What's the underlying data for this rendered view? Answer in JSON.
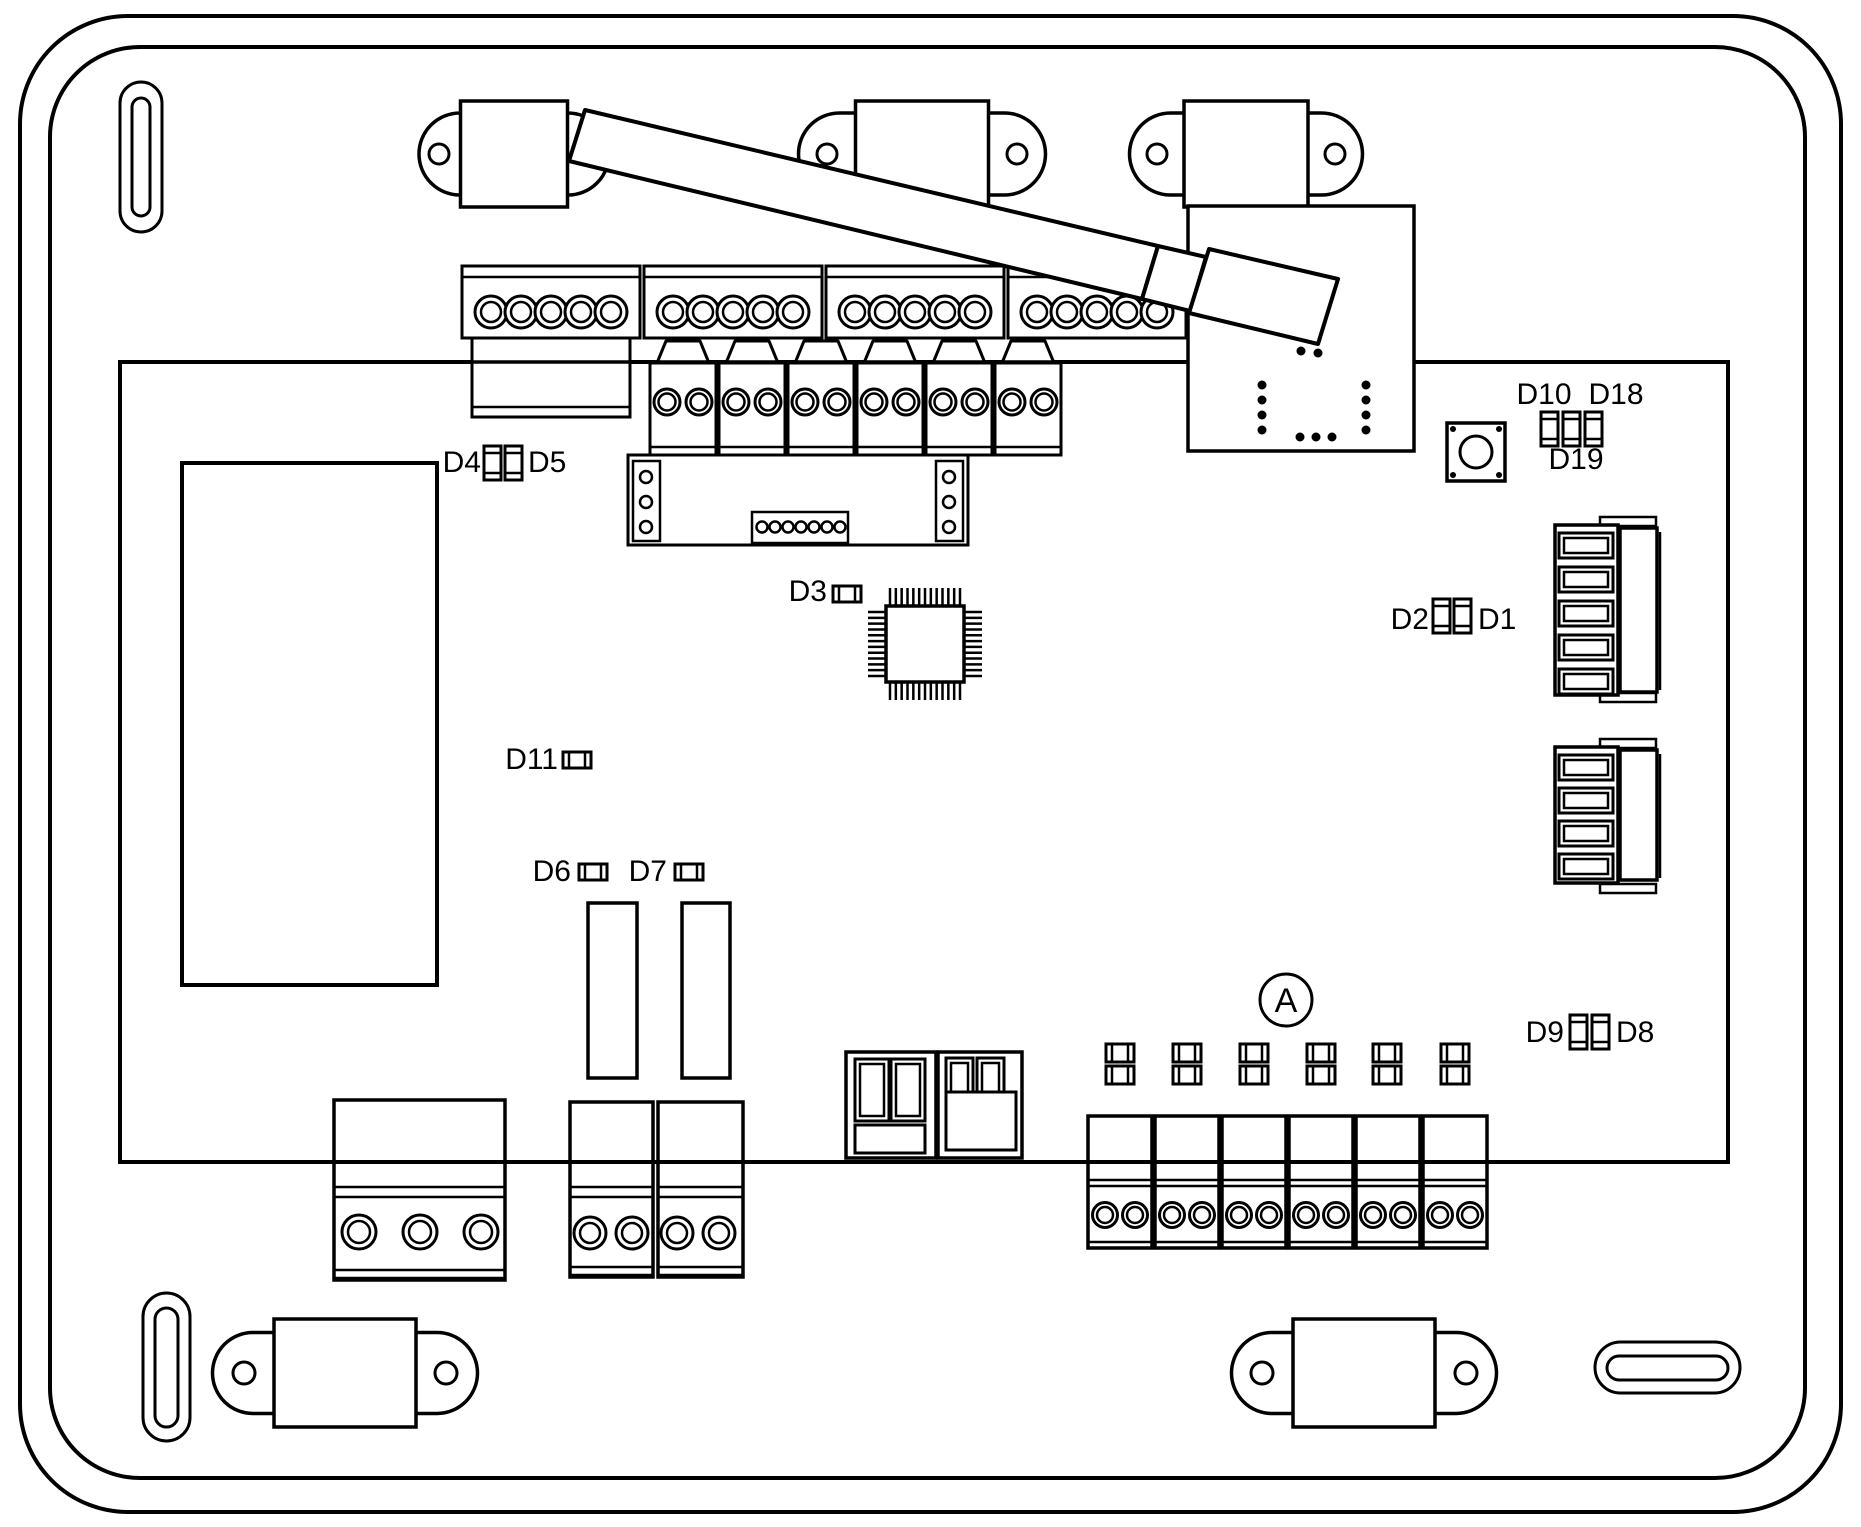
{
  "diagram": {
    "type": "control-board line drawing",
    "colors": {
      "line": "#000000",
      "background": "#ffffff"
    },
    "labels": {
      "d1": "D1",
      "d2": "D2",
      "d3": "D3",
      "d4": "D4",
      "d5": "D5",
      "d6": "D6",
      "d7": "D7",
      "d8": "D8",
      "d9": "D9",
      "d10": "D10",
      "d11": "D11",
      "d18": "D18",
      "d19": "D19",
      "point_a": "A"
    }
  },
  "board": {
    "enclosure": {
      "outer": [
        20,
        16,
        1821,
        1496,
        108
      ],
      "inner": [
        50,
        47,
        1755,
        1431,
        90
      ]
    },
    "pcb": [
      120,
      362,
      1608,
      800
    ],
    "transformer": [
      182,
      463,
      255,
      522
    ],
    "slots": [
      {
        "outer": [
          120,
          82,
          42,
          150
        ],
        "inner": [
          132,
          98,
          18,
          118
        ]
      },
      {
        "outer": [
          143,
          1293,
          47,
          148
        ],
        "inner": [
          155,
          1308,
          23,
          119
        ]
      },
      {
        "outer": [
          1595,
          1342,
          145,
          51
        ],
        "inner": [
          1607,
          1356,
          121,
          24
        ]
      }
    ],
    "tabs": [
      {
        "cx": 514,
        "cy": 154,
        "pw": 190,
        "ph": 82,
        "rw": 107,
        "rh": 106,
        "dx": 75,
        "hr": 10
      },
      {
        "cx": 922,
        "cy": 154,
        "pw": 247,
        "ph": 82,
        "rw": 133,
        "rh": 106,
        "dx": 95,
        "hr": 10
      },
      {
        "cx": 1246,
        "cy": 154,
        "pw": 233,
        "ph": 82,
        "rw": 124,
        "rh": 106,
        "dx": 89,
        "hr": 10
      },
      {
        "cx": 345,
        "cy": 1373,
        "pw": 265,
        "ph": 81,
        "rw": 142,
        "rh": 108,
        "dx": 101,
        "hr": 11
      },
      {
        "cx": 1364,
        "cy": 1373,
        "pw": 265,
        "ph": 81,
        "rw": 142,
        "rh": 108,
        "dx": 102,
        "hr": 11
      }
    ],
    "top_strip": {
      "blocks_x": [
        462,
        644,
        826,
        1008
      ],
      "w": 178,
      "y": 266,
      "h": 72,
      "inner_line_y": 277,
      "screws": 5,
      "screw_cy": 312,
      "r_out": 16,
      "r_in": 10,
      "extension": [
        472,
        338,
        158,
        79
      ],
      "extension_line_y": 407
    },
    "second_row": {
      "blocks_x": [
        650,
        719,
        788,
        857,
        926,
        995
      ],
      "w": 66,
      "y": 363,
      "h": 92,
      "line_y": 447,
      "screw_cy": 402,
      "screw_dx": [
        17,
        49
      ],
      "r_out": 13,
      "r_in": 8.5,
      "trap_top_y": 341
    },
    "header_strip": {
      "body": [
        628,
        455,
        340,
        90
      ],
      "mini_left": {
        "rect": [
          633,
          461,
          27,
          80
        ],
        "cx": 646,
        "cys": [
          477,
          502,
          527
        ],
        "r": 6
      },
      "mini_right": {
        "rect": [
          936,
          461,
          27,
          80
        ],
        "cx": 949,
        "cys": [
          477,
          502,
          527
        ],
        "r": 6
      },
      "center": {
        "rect": [
          752,
          512,
          96,
          31
        ],
        "cy": 527,
        "cx0": 762,
        "step": 13,
        "n": 7,
        "r": 5.5
      }
    },
    "rf_module": {
      "rect": [
        1188,
        206,
        226,
        245
      ],
      "cluster": [
        [
          1300,
          335
        ],
        [
          1317,
          339
        ],
        [
          1301,
          351
        ],
        [
          1318,
          353
        ]
      ],
      "col_left_x": 1262,
      "col_right_x": 1366,
      "col_ys": [
        385,
        400,
        415,
        430
      ],
      "row_y": 437,
      "row_xs": [
        1300,
        1316,
        1332
      ],
      "dot_r": 4.5
    },
    "antenna": {
      "segments": [
        "585,110 1158,246 1142,299 569,161",
        "1158,246 1206,257 1190,311 1142,299",
        "1209,249 1338,279 1318,344 1189,313"
      ]
    },
    "mcu": {
      "body": [
        886,
        606,
        78,
        76
      ],
      "frame": [
        868,
        588,
        114,
        112
      ],
      "pins_top": 13,
      "pins_side": 12
    },
    "relays": [
      [
        588,
        903,
        49,
        175
      ],
      [
        682,
        903,
        48,
        175
      ]
    ],
    "push_button": {
      "rect": [
        1447,
        423,
        58,
        58
      ],
      "circle": [
        1476,
        452,
        16
      ],
      "dot_r": 3,
      "dot_inset": 6
    },
    "right_connectors": [
      {
        "body": [
          1555,
          525,
          63,
          170
        ],
        "slot_x": 1559,
        "slot_w": 54,
        "slot_h": 25,
        "slot_tops": [
          533,
          567,
          601,
          635,
          669
        ],
        "plate": [
          1620,
          528,
          37,
          164
        ],
        "vline": [
          1660,
          532,
          690
        ],
        "steps": [
          [
            1600,
            517,
            56,
            9
          ],
          [
            1600,
            693,
            56,
            9
          ]
        ]
      },
      {
        "body": [
          1555,
          747,
          63,
          136
        ],
        "slot_x": 1559,
        "slot_w": 54,
        "slot_h": 25,
        "slot_tops": [
          755,
          788,
          821,
          854
        ],
        "plate": [
          1620,
          750,
          37,
          130
        ],
        "vline": [
          1660,
          754,
          878
        ],
        "steps": [
          [
            1600,
            739,
            56,
            9
          ],
          [
            1600,
            884,
            56,
            9
          ]
        ]
      }
    ],
    "bottom_left": [
      {
        "rect": [
          334,
          1100,
          171,
          180
        ],
        "lines": [
          1187,
          1197,
          1270,
          1278
        ],
        "screw_cx": [
          359,
          420,
          481
        ],
        "screw_cy": 1232,
        "r_out": 17,
        "r_in": 11
      },
      {
        "rect": [
          570,
          1102,
          83,
          175
        ],
        "lines": [
          1187,
          1197,
          1267,
          1275
        ],
        "screw_cx": [
          590,
          632
        ],
        "screw_cy": 1233,
        "r_out": 16,
        "r_in": 10
      },
      {
        "rect": [
          658,
          1102,
          85,
          175
        ],
        "lines": [
          1187,
          1197,
          1267,
          1275
        ],
        "screw_cx": [
          677,
          719
        ],
        "screw_cy": 1233,
        "r_out": 16,
        "r_in": 10
      }
    ],
    "middle_connectors": {
      "c1": {
        "body": [
          846,
          1052,
          90,
          106
        ],
        "slots": [
          [
            855,
            1059,
            34,
            62
          ],
          [
            891,
            1059,
            34,
            62
          ]
        ],
        "inset": 5,
        "bottom": [
          855,
          1125,
          70,
          28
        ]
      },
      "c2": {
        "body": [
          938,
          1052,
          84,
          106
        ],
        "slots": [
          [
            946,
            1058,
            27,
            42
          ],
          [
            977,
            1058,
            27,
            42
          ]
        ],
        "inset": 5,
        "bottom": [
          946,
          1092,
          70,
          58
        ]
      }
    },
    "led_pairs": {
      "cx": [
        1120,
        1187,
        1254,
        1321,
        1387,
        1455
      ],
      "y_top": 1044,
      "y_bot": 1066,
      "w": 28,
      "h": 18
    },
    "bottom_right": {
      "blocks_x": [
        1088,
        1155,
        1222,
        1289,
        1356,
        1423
      ],
      "w": 64,
      "y": 1116,
      "h": 132,
      "lines": [
        1180,
        1186,
        1242
      ],
      "screw_dx": [
        17,
        47
      ],
      "screw_cy": 1215,
      "r_out": 12.5,
      "r_in": 8
    },
    "point_a": {
      "cx": 1286,
      "cy": 1000,
      "r": 26
    },
    "led_packages": {
      "vertical": [
        [
          484,
          446
        ],
        [
          505,
          446
        ],
        [
          1433,
          599
        ],
        [
          1454,
          599
        ],
        [
          1541,
          412
        ],
        [
          1563,
          412
        ],
        [
          1585,
          412
        ],
        [
          1570,
          1015
        ],
        [
          1592,
          1015
        ]
      ],
      "v_size": [
        17,
        34
      ],
      "horizontal": [
        [
          563,
          752
        ],
        [
          579,
          864
        ],
        [
          675,
          864
        ],
        [
          833,
          586
        ]
      ],
      "h_size": [
        28,
        16
      ]
    },
    "label_pos": [
      {
        "key": "d4",
        "x": 481,
        "y": 472,
        "anchor": "end"
      },
      {
        "key": "d5",
        "x": 528,
        "y": 472,
        "anchor": "start"
      },
      {
        "key": "d3",
        "x": 827,
        "y": 601,
        "anchor": "end"
      },
      {
        "key": "d11",
        "x": 558,
        "y": 769,
        "anchor": "end"
      },
      {
        "key": "d6",
        "x": 571,
        "y": 881,
        "anchor": "end"
      },
      {
        "key": "d7",
        "x": 667,
        "y": 881,
        "anchor": "end"
      },
      {
        "key": "d2",
        "x": 1429,
        "y": 629,
        "anchor": "end"
      },
      {
        "key": "d1",
        "x": 1478,
        "y": 629,
        "anchor": "start"
      },
      {
        "key": "d10",
        "x": 1544,
        "y": 404,
        "anchor": "middle"
      },
      {
        "key": "d18",
        "x": 1616,
        "y": 404,
        "anchor": "middle"
      },
      {
        "key": "d19",
        "x": 1576,
        "y": 469,
        "anchor": "middle"
      },
      {
        "key": "d9",
        "x": 1564,
        "y": 1042,
        "anchor": "end"
      },
      {
        "key": "d8",
        "x": 1616,
        "y": 1042,
        "anchor": "start"
      }
    ],
    "pcb_edge_overlay": {
      "bottom": [
        120,
        1162,
        1728,
        1162
      ],
      "top": [
        120,
        362,
        1188,
        362
      ]
    }
  }
}
